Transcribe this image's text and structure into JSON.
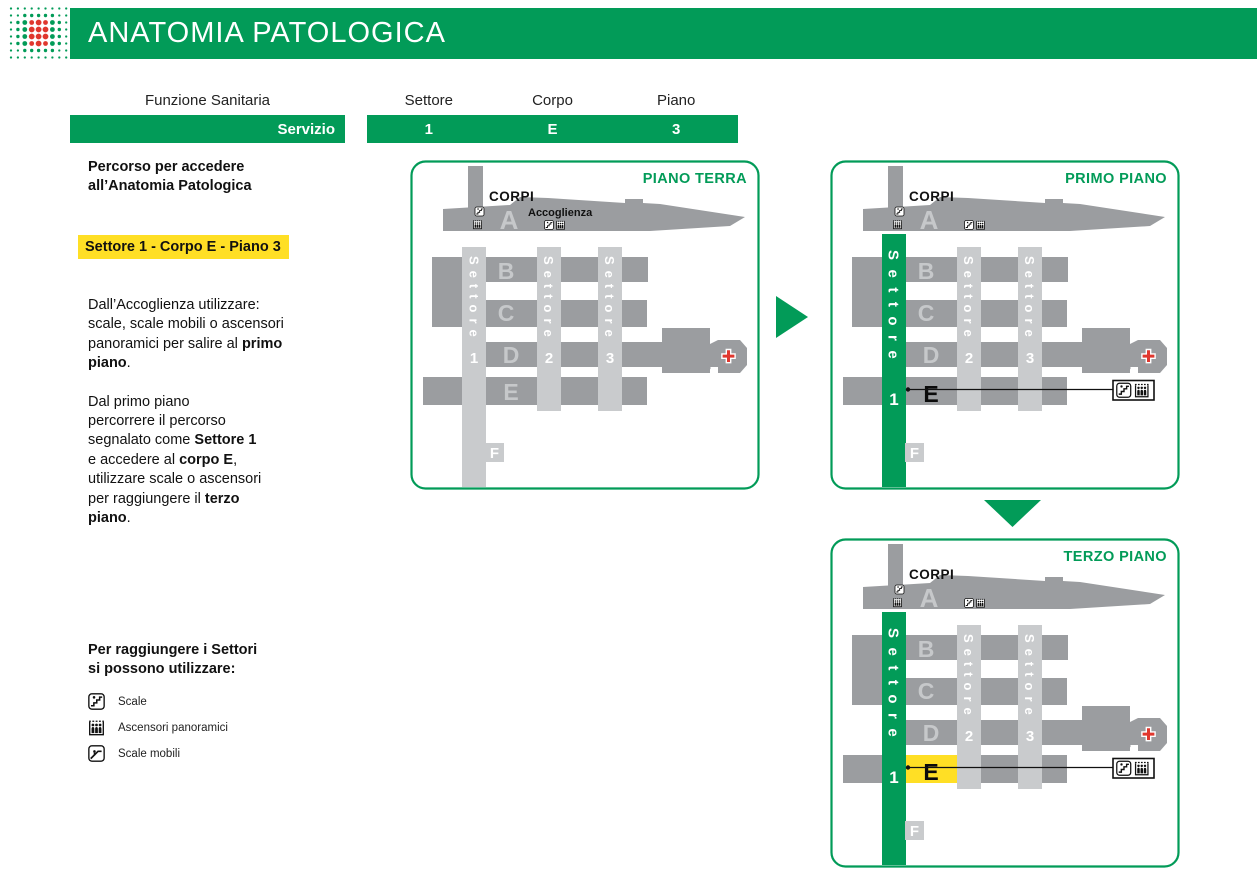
{
  "colors": {
    "green": "#029b58",
    "dark_gray": "#9b9da0",
    "light_gray": "#c9cbcd",
    "letter_gray": "#c6c8ca",
    "yellow": "#ffdf25",
    "red": "#e0372e",
    "black": "#111111",
    "white": "#ffffff"
  },
  "header": {
    "title": "ANATOMIA PATOLOGICA"
  },
  "logo": {
    "name": "dot-matrix-logo"
  },
  "route_table": {
    "function_header": "Funzione Sanitaria",
    "function_value": "Servizio",
    "columns": [
      {
        "header": "Settore",
        "value": "1"
      },
      {
        "header": "Corpo",
        "value": "E"
      },
      {
        "header": "Piano",
        "value": "3"
      }
    ]
  },
  "sidebar": {
    "intro_lines": [
      "Percorso per accedere",
      "all’Anatomia Patologica"
    ],
    "highlight": "Settore 1 - Corpo E - Piano 3",
    "paragraphs": [
      {
        "segments": [
          {
            "text": "Dall’Accoglienza utilizzare:\nscale, scale mobili o ascensori\npanoramici per salire al ",
            "bold": false
          },
          {
            "text": "primo\npiano",
            "bold": true
          },
          {
            "text": ".",
            "bold": false
          }
        ]
      },
      {
        "segments": [
          {
            "text": "Dal primo piano\npercorrere il percorso\nsegnalato come ",
            "bold": false
          },
          {
            "text": "Settore 1",
            "bold": true
          },
          {
            "text": "\ne accedere al ",
            "bold": false
          },
          {
            "text": "corpo E",
            "bold": true
          },
          {
            "text": ",\nutilizzare scale o ascensori\nper raggiungere il ",
            "bold": false
          },
          {
            "text": "terzo\npiano",
            "bold": true
          },
          {
            "text": ".",
            "bold": false
          }
        ]
      }
    ],
    "legend_title_lines": [
      "Per raggiungere i Settori",
      "si possono utilizzare:"
    ],
    "legend": [
      {
        "icon": "stairs-icon",
        "label": "Scale"
      },
      {
        "icon": "panoramic-elevator-icon",
        "label": "Ascensori panoramici"
      },
      {
        "icon": "escalator-icon",
        "label": "Scale mobili"
      }
    ]
  },
  "maps": [
    {
      "title": "PIANO TERRA",
      "corpi_label": "CORPI",
      "accoglienza_label": "Accoglienza",
      "sectors": [
        {
          "word": "Settore",
          "number": "1"
        },
        {
          "word": "Settore",
          "number": "2"
        },
        {
          "word": "Settore",
          "number": "3"
        }
      ],
      "corpi": {
        "a": "A",
        "b": "B",
        "c": "C",
        "d": "D",
        "e": "E",
        "f": "F"
      },
      "route_highlight": {
        "sector1_green": false,
        "corpo_e_black": false,
        "corpo_e_yellow": false,
        "callout": false
      },
      "callout_icons": []
    },
    {
      "title": "PRIMO PIANO",
      "corpi_label": "CORPI",
      "accoglienza_label": "",
      "sectors": [
        {
          "word": "Settore",
          "number": "1"
        },
        {
          "word": "Settore",
          "number": "2"
        },
        {
          "word": "Settore",
          "number": "3"
        }
      ],
      "corpi": {
        "a": "A",
        "b": "B",
        "c": "C",
        "d": "D",
        "e": "E",
        "f": "F"
      },
      "route_highlight": {
        "sector1_green": true,
        "corpo_e_black": true,
        "corpo_e_yellow": false,
        "callout": true
      },
      "callout_icons": [
        "stairs-icon",
        "panoramic-elevator-icon"
      ]
    },
    {
      "title": "TERZO PIANO",
      "corpi_label": "CORPI",
      "accoglienza_label": "",
      "sectors": [
        {
          "word": "Settore",
          "number": "1"
        },
        {
          "word": "Settore",
          "number": "2"
        },
        {
          "word": "Settore",
          "number": "3"
        }
      ],
      "corpi": {
        "a": "A",
        "b": "B",
        "c": "C",
        "d": "D",
        "e": "E",
        "f": "F"
      },
      "route_highlight": {
        "sector1_green": true,
        "corpo_e_black": true,
        "corpo_e_yellow": true,
        "callout": true
      },
      "callout_icons": [
        "stairs-icon",
        "panoramic-elevator-icon"
      ]
    }
  ]
}
